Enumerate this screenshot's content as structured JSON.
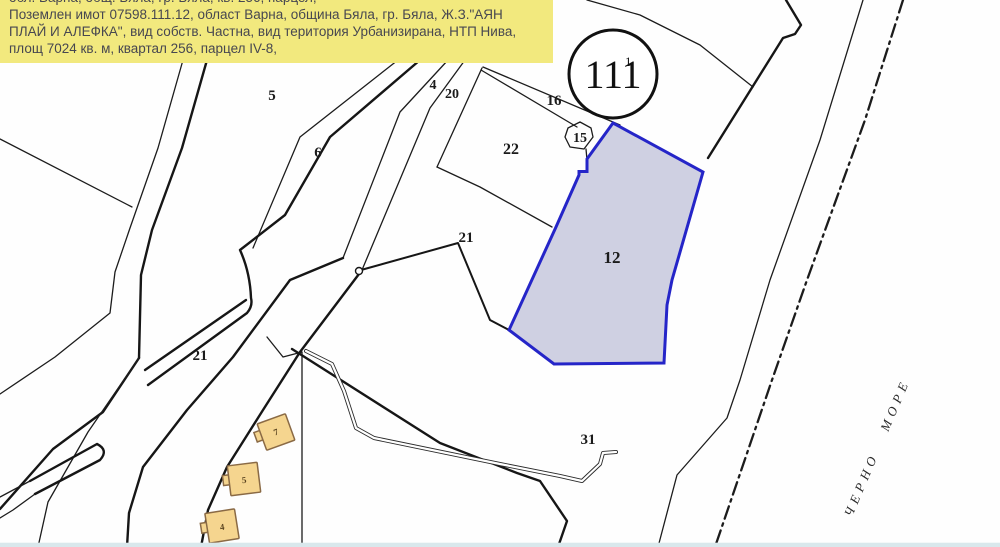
{
  "info_box": {
    "clipped_line": "обл. Варна, общ. Бяла, гр. Бяла, кв. 256, парцел,",
    "line1": "Поземлен имот 07598.111.12, област Варна, община Бяла, гр. Бяла, Ж.З.\"АЯН",
    "line2": "ПЛАЙ И АЛЕФКА\", вид собств. Частна, вид територия Урбанизирана, НТП Нива,",
    "line3": "площ 7024 кв. м, квартал 256, парцел IV-8,"
  },
  "block_circle": {
    "number": "111",
    "superscript": "1"
  },
  "highlighted_parcel": {
    "label": "12"
  },
  "parcel_labels": {
    "p5": "5",
    "p6": "6",
    "p4": "4",
    "p20": "20",
    "p16": "16",
    "p15": "15",
    "p22": "22",
    "p21a": "21",
    "p21b": "21",
    "p31": "31",
    "p5_partial": "5"
  },
  "buildings": {
    "b7": "7",
    "b5": "5",
    "b4": "4"
  },
  "sea_label": "ЧЕРНО МОРЕ",
  "colors": {
    "info_bg": "#f2e97e",
    "info_text": "#474750",
    "parcel_fill": "#cfd0e2",
    "parcel_border": "#2525c8",
    "building_fill": "#f5d58f",
    "building_border": "#8a6a45",
    "sea_strip": "#d9e8ec",
    "map_line": "#1c1c1c"
  }
}
